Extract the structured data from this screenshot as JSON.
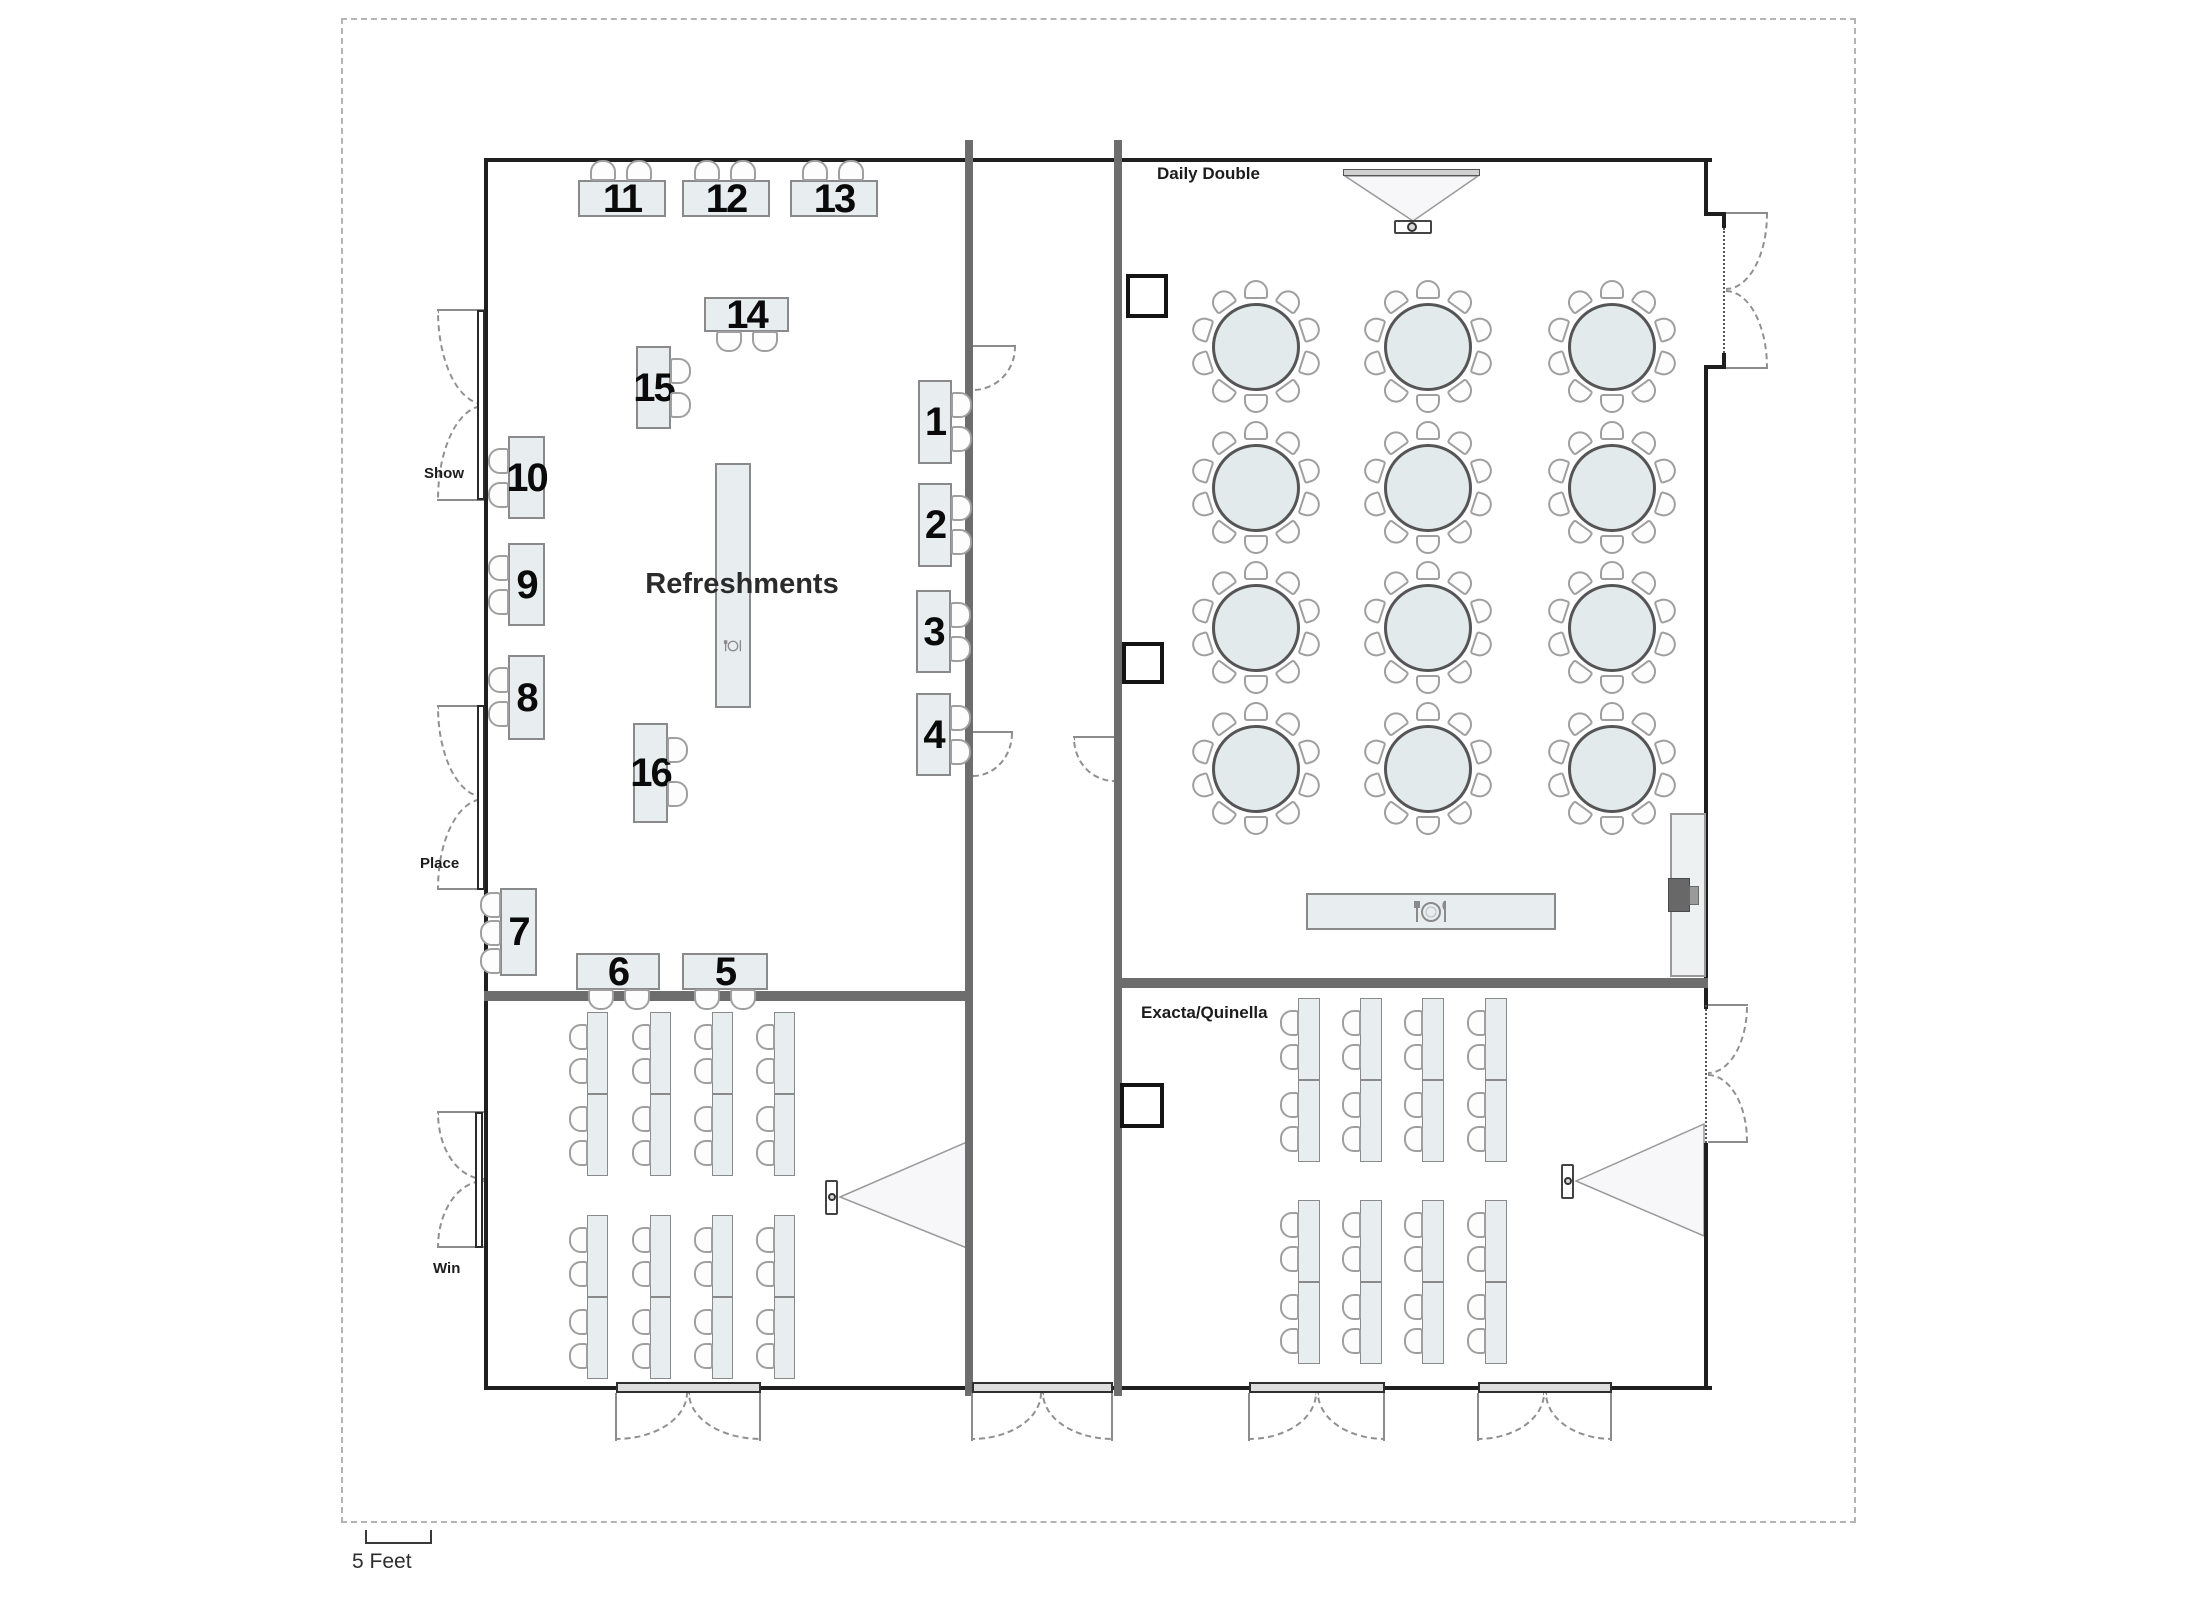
{
  "labels": {
    "daily_double": "Daily Double",
    "exacta_quinella": "Exacta/Quinella",
    "show": "Show",
    "place": "Place",
    "win": "Win",
    "refreshments": "Refreshments",
    "scale": "5 Feet"
  },
  "colors": {
    "wall": "#1f1f1f",
    "partition": "#6d6d6d",
    "table_fill": "#e8edef",
    "table_border": "#8a8a8a",
    "chair_fill": "#fdfdfd",
    "chair_border": "#9f9f9f",
    "number": "#0a0a0a",
    "beam_fill": "#f7f7f9",
    "beam_border": "#999999"
  },
  "icons": {
    "buffet_marker": "place-setting-icon",
    "refreshments_marker": "place-setting-icon",
    "projection": "projector-with-beam-icon",
    "speaker_stand": "podium-icon"
  },
  "exhibit_room": {
    "door_labels": [
      "Show",
      "Place",
      "Win"
    ],
    "refreshments_table": {
      "label": "Refreshments"
    },
    "tables": [
      {
        "num": "11",
        "x": 578,
        "y": 180,
        "w": 88,
        "h": 37,
        "side": "top",
        "count": 2
      },
      {
        "num": "12",
        "x": 682,
        "y": 180,
        "w": 88,
        "h": 37,
        "side": "top",
        "count": 2
      },
      {
        "num": "13",
        "x": 790,
        "y": 180,
        "w": 88,
        "h": 37,
        "side": "top",
        "count": 2
      },
      {
        "num": "14",
        "x": 704,
        "y": 297,
        "w": 85,
        "h": 35,
        "side": "bottom",
        "count": 2
      },
      {
        "num": "15",
        "x": 636,
        "y": 346,
        "w": 35,
        "h": 83,
        "side": "right",
        "count": 2
      },
      {
        "num": "10",
        "x": 508,
        "y": 436,
        "w": 37,
        "h": 83,
        "side": "left",
        "count": 2
      },
      {
        "num": "9",
        "x": 508,
        "y": 543,
        "w": 37,
        "h": 83,
        "side": "left",
        "count": 2
      },
      {
        "num": "8",
        "x": 508,
        "y": 655,
        "w": 37,
        "h": 85,
        "side": "left",
        "count": 2
      },
      {
        "num": "7",
        "x": 500,
        "y": 888,
        "w": 37,
        "h": 88,
        "side": "left",
        "count": 3
      },
      {
        "num": "16",
        "x": 633,
        "y": 723,
        "w": 35,
        "h": 100,
        "side": "right",
        "count": 2
      },
      {
        "num": "6",
        "x": 576,
        "y": 953,
        "w": 84,
        "h": 37,
        "side": "bottom",
        "count": 2
      },
      {
        "num": "5",
        "x": 682,
        "y": 953,
        "w": 86,
        "h": 37,
        "side": "bottom",
        "count": 2
      },
      {
        "num": "1",
        "x": 918,
        "y": 380,
        "w": 34,
        "h": 84,
        "side": "right",
        "count": 2
      },
      {
        "num": "2",
        "x": 918,
        "y": 483,
        "w": 34,
        "h": 84,
        "side": "right",
        "count": 2
      },
      {
        "num": "3",
        "x": 916,
        "y": 590,
        "w": 35,
        "h": 83,
        "side": "right",
        "count": 2
      },
      {
        "num": "4",
        "x": 916,
        "y": 693,
        "w": 35,
        "h": 83,
        "side": "right",
        "count": 2
      }
    ]
  },
  "daily_double_room": {
    "name": "Daily Double",
    "round_tables": {
      "cols": [
        1256,
        1428,
        1612
      ],
      "rows": [
        347,
        488,
        628,
        769
      ],
      "radius": 44,
      "chairs_per_table": 10
    },
    "buffet_table": {
      "icon": "place-setting-icon"
    }
  },
  "win_room": {
    "name": "Win",
    "classroom": {
      "columns": [
        587,
        650,
        712,
        774
      ],
      "col_width": 21,
      "blocks": [
        1012,
        1215
      ],
      "table_height": 82,
      "tables_per_block": 2,
      "chairs_per_table": 2,
      "chair_side": "left"
    }
  },
  "exacta_room": {
    "name": "Exacta/Quinella",
    "classroom": {
      "columns": [
        1298,
        1360,
        1422,
        1485
      ],
      "col_width": 22,
      "blocks": [
        998,
        1200
      ],
      "table_height": 82,
      "tables_per_block": 2,
      "chairs_per_table": 2,
      "chair_side": "left"
    }
  },
  "scale_bar": {
    "label": "5 Feet"
  }
}
